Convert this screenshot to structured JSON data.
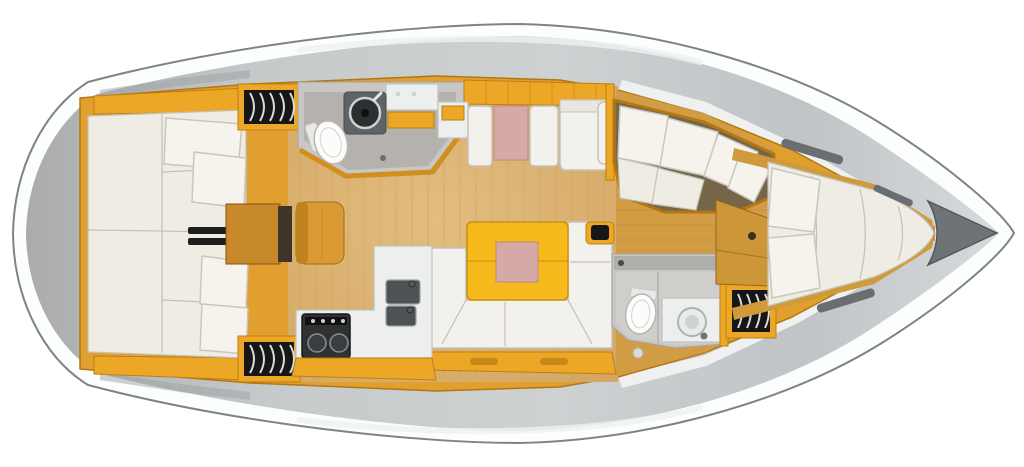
{
  "figure": {
    "kind": "sailing-yacht-interior-floor-plan",
    "view": "top-down",
    "bow_direction": "right"
  },
  "palette": {
    "hull": "#fcfdfd",
    "hullStroke": "#7d8488",
    "deckA": "#a9abad",
    "deckB": "#c7cacb",
    "deckC": "#ced1d2",
    "deckD": "#c0c4c6",
    "deckE": "#d7dadb",
    "deckLight": "#eff1f1",
    "trim": "#e09f2e",
    "trimDark": "#b37712",
    "cabinet": "#eda726",
    "cabinetDark": "#bd7f12",
    "woodSalonA": "#e3bd7f",
    "woodSalonB": "#d3a763",
    "woodSalonDark": "#c49c58",
    "woodFwd": "#d29c44",
    "woodFwdDark": "#bd8a33",
    "woodBand": "#cf9a3a",
    "furnWood": "#c8892b",
    "furnWoodDark": "#86500c",
    "desk": "#cd9738",
    "seat": "#d99a33",
    "mattress": "#efece3",
    "mattressSeam": "#c3c0b7",
    "pillow": "#f6f3ec",
    "pillowStroke": "#c9c6bd",
    "settee": "#f3f1ec",
    "setteeStroke": "#c5c2bb",
    "counter": "#edefee",
    "counterStroke": "#c0c2c1",
    "sink": "#4e5254",
    "stove": "#2f3133",
    "headWall": "#c9c7c3",
    "headFloor": "#b5b2ae",
    "fixture": "#fcfcfa",
    "fixtureStroke": "#b6b6b4",
    "locker": "#161616",
    "lockerLine": "#d8dbdc",
    "table": "#f6ba1c",
    "tableStroke": "#ca9015",
    "tablePad": "#d5aaa6",
    "anchor": "#6f7376",
    "hatch": "#6a6e71",
    "mast": "#151617",
    "nookFloor": "#756549"
  },
  "areas": [
    {
      "name": "aft-cabin-port",
      "features": [
        "double-berth",
        "two-pillows",
        "hull-shelf",
        "hanging-locker"
      ]
    },
    {
      "name": "aft-cabin-starboard",
      "features": [
        "double-berth",
        "two-pillows",
        "hull-shelf",
        "hanging-locker"
      ]
    },
    {
      "name": "companionway",
      "features": [
        "steps"
      ]
    },
    {
      "name": "nav-station",
      "features": [
        "chart-table",
        "seat"
      ]
    },
    {
      "name": "head-aft-port",
      "features": [
        "toilet",
        "round-washbasin",
        "vanity",
        "shower-floor"
      ]
    },
    {
      "name": "dinette-port",
      "features": [
        "facing-benches",
        "cocktail-table",
        "settee-with-armrest"
      ]
    },
    {
      "name": "salon",
      "features": [
        "u-shaped-settee",
        "folding-table-with-insert",
        "mast-post",
        "storage-drawers"
      ]
    },
    {
      "name": "galley-starboard",
      "features": [
        "l-shaped-counter",
        "double-sink",
        "two-burner-stove"
      ]
    },
    {
      "name": "head-forward-starboard",
      "features": [
        "toilet",
        "round-washbasin",
        "vanity"
      ]
    },
    {
      "name": "forward-cabin",
      "features": [
        "v-berth",
        "two-pillows",
        "seating-nook",
        "vanity-desk",
        "hanging-locker"
      ]
    },
    {
      "name": "anchor-locker",
      "features": [
        "bow-stowage"
      ]
    }
  ],
  "visible_fixture_counts": {
    "double_berths": 3,
    "toilets": 2,
    "washbasins": 2,
    "galley_sinks": 2,
    "stove_burners": 2,
    "hanging_lockers": 3,
    "tables": 3,
    "deck_hatches": 3
  }
}
